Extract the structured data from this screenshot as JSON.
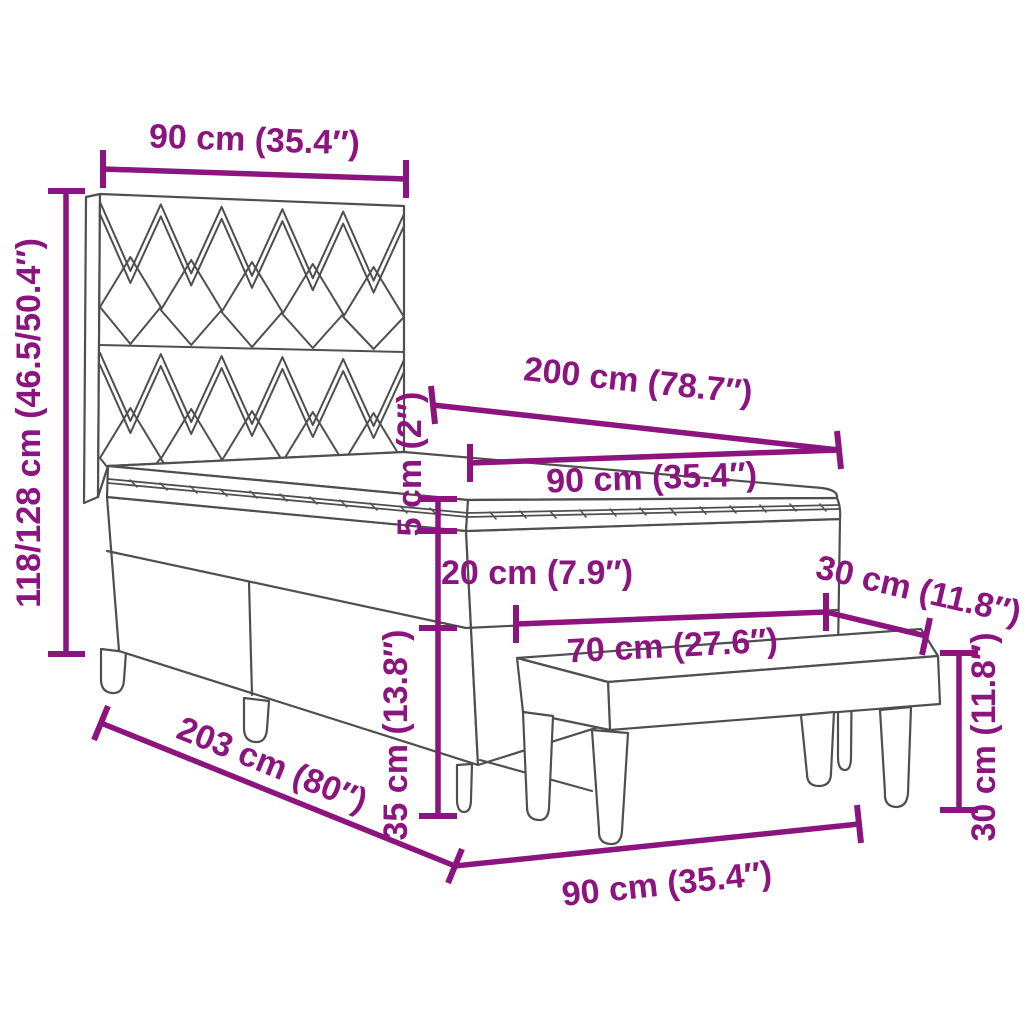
{
  "diagram": {
    "type": "product-dimension-diagram",
    "subject": "box spring bed with headboard, mattress topper and bench"
  },
  "dimensions": {
    "headboard_width": "90 cm (35.4″)",
    "headboard_height": "118/128 cm (46.5/50.4″)",
    "mattress_length": "200 cm (78.7″)",
    "mattress_width": "90 cm (35.4″)",
    "topper_thickness": "5 cm (2″)",
    "box_height": "20 cm (7.9″)",
    "bench_depth": "30 cm (11.8″)",
    "bench_length": "70 cm (27.6″)",
    "leg_height": "35 cm (13.8″)",
    "bench_height": "30 cm (11.8″)",
    "bed_length": "203 cm (80″)",
    "bed_width": "90 cm (35.4″)"
  },
  "colors": {
    "dimension": "#8c147e",
    "line_art": "#4f4f4f",
    "background": "#ffffff"
  }
}
